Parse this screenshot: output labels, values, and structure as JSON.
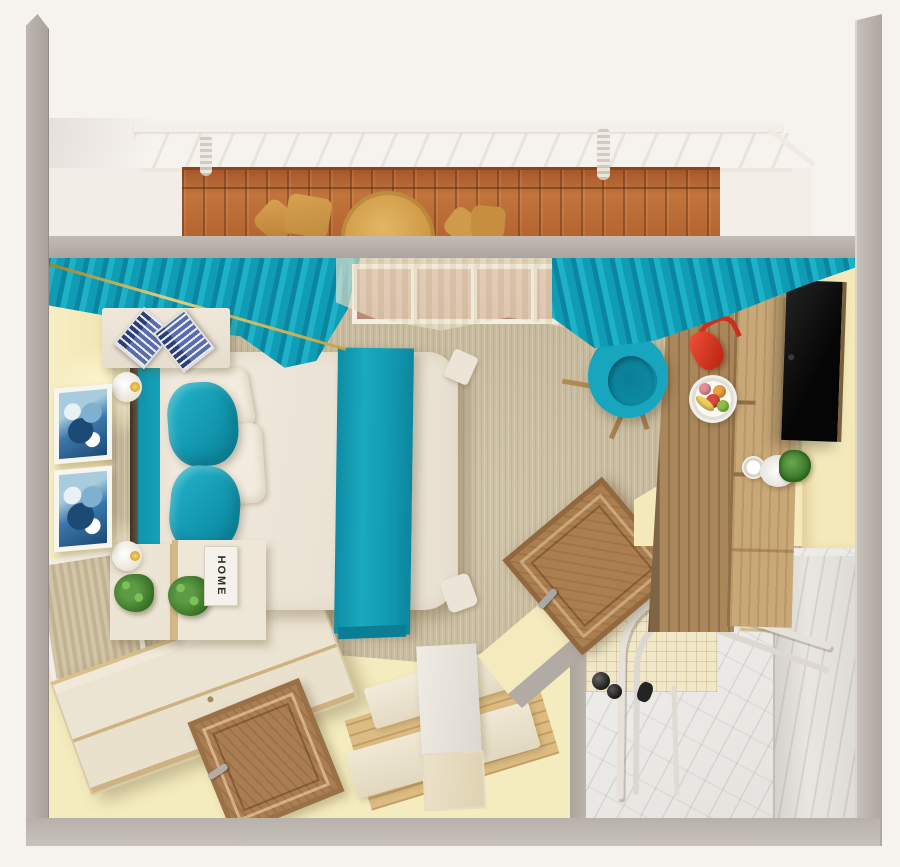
{
  "scene": {
    "type": "3d-top-down-floor-plan-render",
    "description": "Photorealistic top-down 3D render of a hotel studio room with balcony, bedroom area and en-suite bathroom",
    "areas": [
      "balcony",
      "bedroom",
      "bathroom"
    ]
  },
  "balcony": {
    "objects": [
      "white railing",
      "wooden deck",
      "two tan armchairs",
      "round rattan table",
      "awning springs"
    ]
  },
  "bedroom": {
    "objects": [
      "teal curtains",
      "sheer curtain over window",
      "double bed with white duvet",
      "teal accent runner",
      "two teal pillows",
      "two white pillows",
      "teal fitted sheet",
      "dark headboard",
      "headboard shelf with two patterned books",
      "two globe wall lamps",
      "two blue abstract artworks",
      "two nightstands with potted plants",
      "HOME letter block",
      "leaning framed mirror",
      "long cream dresser",
      "wooden entry door",
      "bench seating set with white table",
      "wooden desk with open shelves",
      "flat-screen TV",
      "red handbag",
      "fruit plate",
      "white mug",
      "white planter with green plant",
      "teal swivel chair",
      "air-conditioning unit",
      "white wall shelf"
    ]
  },
  "bathroom": {
    "objects": [
      "wooden door ajar",
      "curved shower-screen frame",
      "black shower fixtures",
      "beige mosaic tile wall",
      "marble wall",
      "marble floor",
      "towel warmer panel",
      "white vanity ledge"
    ]
  },
  "decor": {
    "home_sign_text": "HOME"
  },
  "palette": {
    "teal": "#14a3b9",
    "curtain_teal_dark": "#0b86a0",
    "wall_cream": "#f5ebc0",
    "wall_gray": "#b3aca6",
    "carpet_beige": "#cbbd9d",
    "deck_wood": "#b4632f",
    "furniture_wood": "#c9a877",
    "accent_red": "#d93b28",
    "duvet_white": "#ece5d8",
    "marble_white": "#ecebe7",
    "gold": "#d4a93f",
    "plant_green": "#4d8a3c",
    "tv_black": "#111111"
  }
}
